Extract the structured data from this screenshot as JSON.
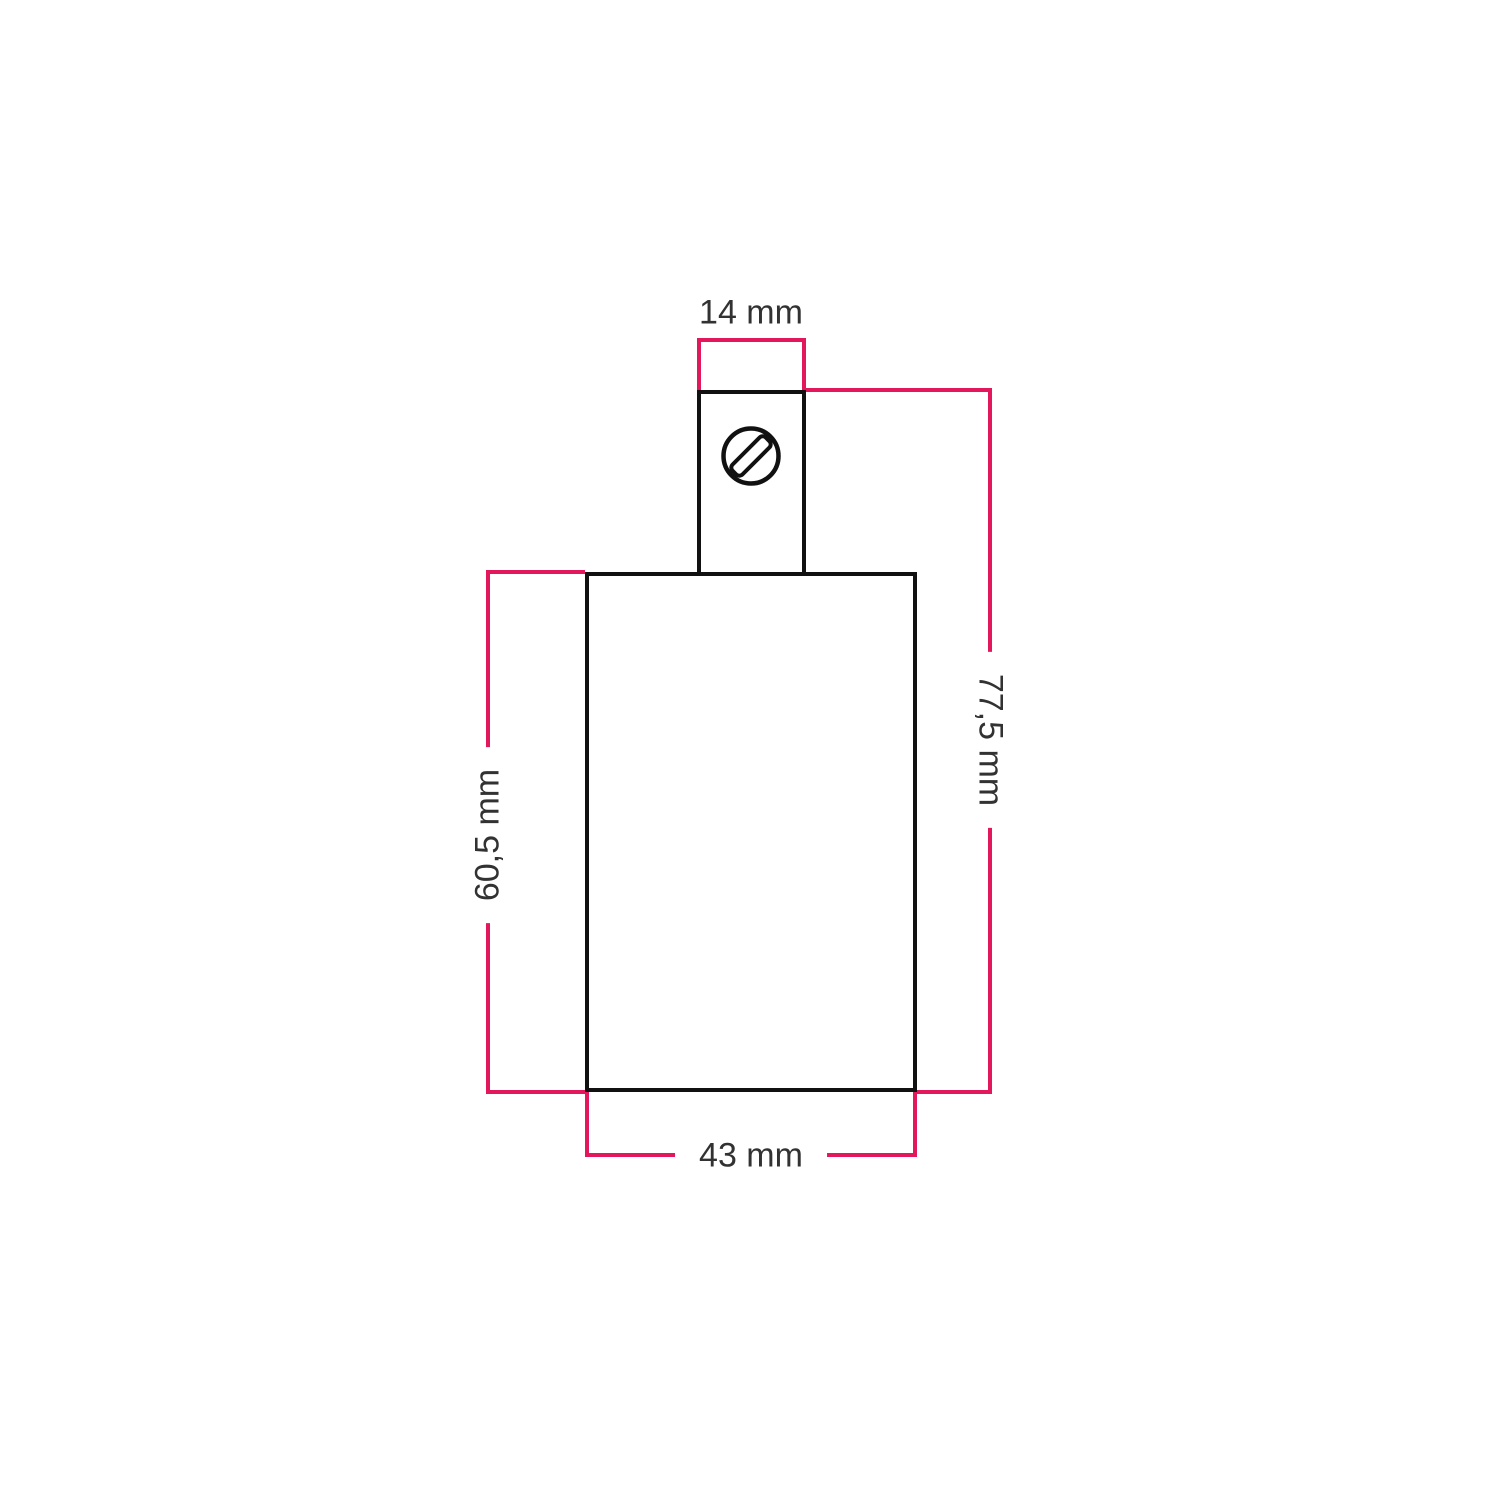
{
  "diagram": {
    "type": "technical-dimension-drawing",
    "dimension_labels": {
      "top": "14 mm",
      "right": "77,5 mm",
      "left": "60,5 mm",
      "bottom": "43 mm"
    },
    "colors": {
      "dimension_line": "#E2175C",
      "outline": "#111111",
      "label_text": "#323232",
      "background": "#FFFFFF"
    },
    "icons": {
      "screw": "slotted-screw-icon"
    }
  }
}
